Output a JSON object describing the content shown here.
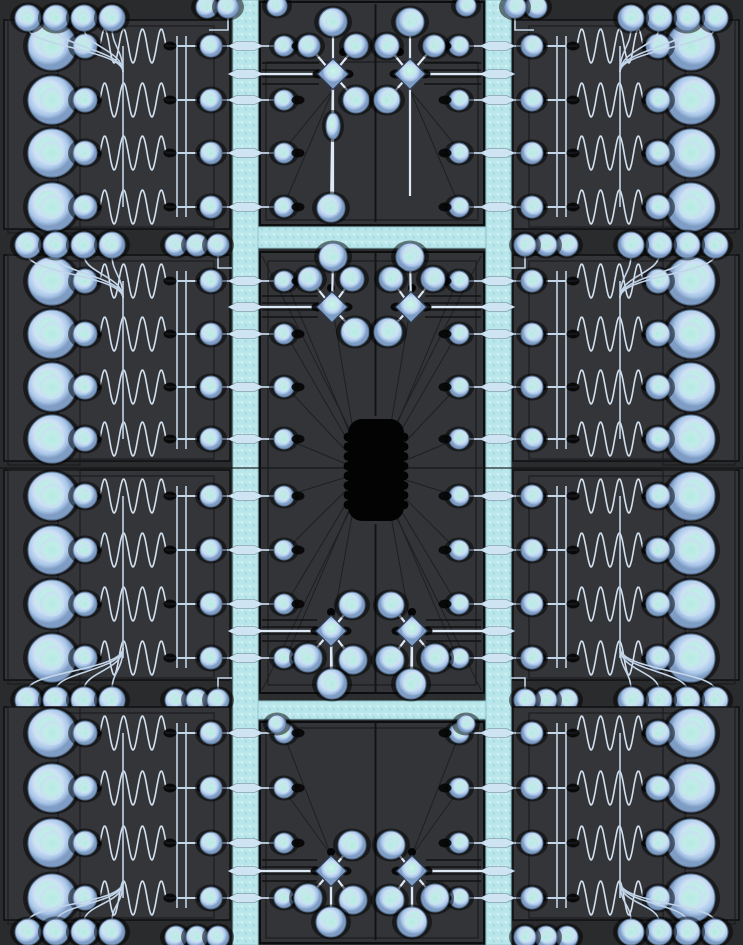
{
  "meta": {
    "width": 743,
    "height": 945,
    "description": "mems-chip-die-layout"
  },
  "colors": {
    "page_bg": "#1f2021",
    "column_bg": "#2a2b2d",
    "center_bg": "#2c2d2f",
    "panel_fill": "#343539",
    "center_fill": "#333438",
    "stroke_dark": "#0d0e0f",
    "stroke_inner": "#1b1c1e",
    "fanline": "#1e1f21",
    "cyan": "#b9e6ea",
    "cyan_speck_light": "#d2f1f4",
    "cyan_speck_dark": "#9fd6dd",
    "cyan_edge": "#8cc3ca",
    "trace": "#c3d5e9",
    "trace_bright": "#dde9f6",
    "blob_black": "#050506",
    "pad_rim": "#7f9cc4",
    "pad_mid": "#cfe1f5",
    "pad_core": "#bdece6",
    "chip_black": "#030304"
  },
  "channels": {
    "vertical": [
      [
        233,
        0,
        25,
        945
      ],
      [
        486,
        0,
        25,
        945
      ]
    ],
    "horizontal": [
      [
        258,
        227,
        228,
        21
      ],
      [
        258,
        701,
        228,
        18
      ]
    ]
  },
  "chip": {
    "x": 348,
    "y": 419,
    "w": 56,
    "h": 102,
    "rx": 14,
    "bump_r": 4.4,
    "bump_ys": [
      437,
      446.7,
      456.4,
      466.1,
      475.8,
      485.5,
      495.2,
      504.9
    ]
  },
  "row_geom": {
    "big_x": 52,
    "big_r": 24,
    "med_x": 85,
    "med_r": 12,
    "pad_x": 211,
    "pad_r": 11,
    "sine_x0": 100,
    "sine_x1": 166,
    "amp": 17,
    "cycles": 3.5,
    "blob_xs": [
      95,
      170,
      203
    ],
    "rail_fan_x": 123,
    "rail_xs": [
      177,
      186
    ],
    "bar_x": 233
  },
  "bands": [
    {
      "rows": [
        46,
        100,
        153,
        207
      ],
      "fan": {
        "side": "top",
        "pad_y": 18,
        "conv_y": 72,
        "pad_xs": [
          28,
          56,
          84,
          112
        ],
        "pad_r": 13
      },
      "aux": [
        {
          "y": 7,
          "xs": [
            207,
            228
          ],
          "r": 11,
          "elbow": [
            [
              228,
              16
            ],
            [
              228,
              30
            ],
            [
              209,
              30
            ]
          ]
        }
      ]
    },
    {
      "rows": [
        281,
        334,
        387,
        439
      ],
      "fan": {
        "side": "top",
        "pad_y": 245,
        "conv_y": 298,
        "pad_xs": [
          28,
          56,
          84,
          112
        ],
        "pad_r": 13
      },
      "aux": [
        {
          "y": 245,
          "xs": [
            176,
            197,
            218
          ],
          "r": 11,
          "elbow": [
            [
              218,
              255
            ],
            [
              218,
              268
            ],
            [
              232,
              268
            ]
          ]
        }
      ]
    },
    {
      "rows": [
        496,
        550,
        604,
        658
      ],
      "fan": {
        "side": "bottom",
        "pad_y": 700,
        "conv_y": 648,
        "pad_xs": [
          28,
          56,
          84,
          112
        ],
        "pad_r": 13
      },
      "aux": [
        {
          "y": 700,
          "xs": [
            176,
            197,
            218
          ],
          "r": 11,
          "elbow": [
            [
              218,
              690
            ],
            [
              218,
              678
            ],
            [
              232,
              678
            ]
          ]
        }
      ]
    },
    {
      "rows": [
        733,
        788,
        843,
        898
      ],
      "fan": {
        "side": "bottom",
        "pad_y": 932,
        "conv_y": 882,
        "pad_xs": [
          28,
          56,
          84,
          112
        ],
        "pad_r": 13
      },
      "aux": [
        {
          "y": 937,
          "xs": [
            176,
            197,
            218
          ],
          "r": 11
        }
      ]
    }
  ],
  "center": {
    "sections": [
      {
        "name": "A",
        "rect": [
          260,
          2,
          224,
          223
        ],
        "inner": [
          266,
          62,
          212,
          158
        ]
      },
      {
        "name": "B",
        "rect": [
          260,
          252,
          224,
          441
        ],
        "inner": [
          268,
          261,
          208,
          424
        ]
      },
      {
        "name": "C",
        "rect": [
          260,
          722,
          224,
          221
        ],
        "inner": [
          266,
          728,
          212,
          210
        ]
      }
    ],
    "axis_x": 375.5,
    "vlines": [
      [
        4,
        222
      ],
      [
        252,
        416
      ],
      [
        524,
        692
      ],
      [
        722,
        940
      ]
    ],
    "midline_y": 468,
    "edge_pad_x": 284,
    "edge_pad_r": 10,
    "edge_blob_x": 298,
    "lens_cx": 245.5,
    "edge_rows": {
      "A": [
        46,
        100,
        153,
        207
      ],
      "B": [
        281,
        334,
        387,
        439,
        496,
        550,
        604,
        658
      ],
      "C": [
        733,
        788,
        843,
        898
      ]
    },
    "feeds": [
      74,
      307,
      631,
      871
    ],
    "top_pads": [
      [
        277,
        6,
        10
      ],
      [
        277,
        724,
        9
      ]
    ],
    "dots": [
      [
        343,
        52
      ],
      [
        331,
        288
      ],
      [
        331,
        612
      ],
      [
        331,
        852
      ]
    ],
    "clusters": [
      {
        "d": [
          333,
          74
        ],
        "pads": [
          [
            333,
            22,
            14
          ],
          [
            309,
            46,
            11
          ],
          [
            356,
            46,
            12
          ],
          [
            356,
            100,
            13
          ]
        ],
        "vline": [
          86,
          196
        ],
        "oval": [
          333,
          126
        ],
        "bottom": [
          331,
          208,
          14
        ],
        "oval_left_only": true
      },
      {
        "d": [
          332,
          307
        ],
        "pads": [
          [
            333,
            257,
            14
          ],
          [
            310,
            279,
            12
          ],
          [
            352,
            279,
            12
          ],
          [
            355,
            332,
            14
          ]
        ]
      },
      {
        "d": [
          331,
          631
        ],
        "pads": [
          [
            352,
            605,
            13
          ],
          [
            308,
            658,
            14
          ],
          [
            353,
            660,
            14
          ]
        ],
        "bottom": [
          332,
          684,
          15
        ],
        "vline": [
          643,
          670
        ]
      },
      {
        "d": [
          331,
          871
        ],
        "pads": [
          [
            352,
            845,
            14
          ],
          [
            308,
            898,
            14
          ],
          [
            353,
            900,
            14
          ]
        ],
        "bottom": [
          331,
          922,
          15
        ],
        "vline": [
          883,
          908
        ]
      }
    ],
    "detail_line_offsets": [
      -11,
      -4,
      3,
      10
    ]
  }
}
